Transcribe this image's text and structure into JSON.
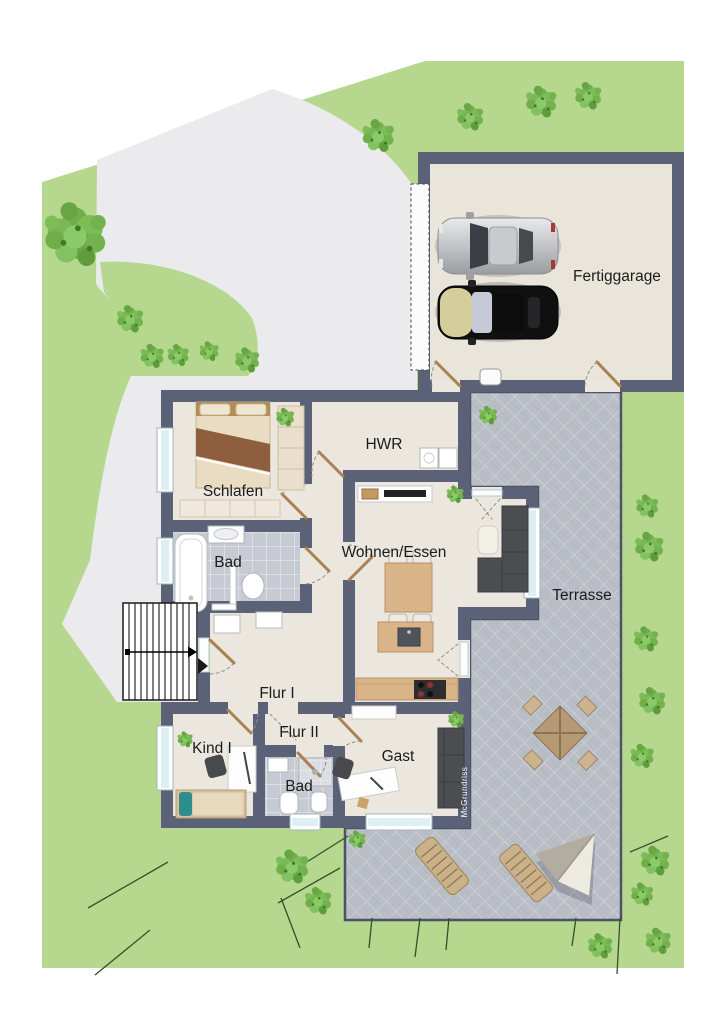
{
  "plan": {
    "type": "residential-site-floor-plan",
    "labels": {
      "garage": "Fertiggarage",
      "utility": "HWR",
      "bedroom": "Schlafen",
      "bath_upper": "Bad",
      "living_dining": "Wohnen/Essen",
      "terrace": "Terrasse",
      "hall_1": "Flur I",
      "hall_2": "Flur II",
      "child_room": "Kind I",
      "guest_room": "Gast",
      "bath_lower": "Bad",
      "watermark": "McGrundriss"
    },
    "colors": {
      "page_background": "#ffffff",
      "garden_green": "#b6d88e",
      "bush_green": "#6fae49",
      "driveway_gray": "#ebebee",
      "wall_dark": "#5b6277",
      "floor_cream": "#ece7de",
      "garage_floor": "#e9e5db",
      "bath_tile": "#c6cad2",
      "terrace_tile": "#b9bdc5",
      "window_blue": "#dceff2",
      "door_wood": "#a9824f",
      "furniture_wood": "#d8b488",
      "sofa_gray": "#4b4d50",
      "bed_blanket": "#8f5e3e",
      "car_silver": "#c9cacd",
      "car_black": "#101010",
      "car_hood_beige": "#d5cd9b"
    },
    "symbols": {
      "stairs": "exterior-stairs-with-direction-arrow",
      "cars": [
        "silver-car-top-view",
        "black-car-top-view"
      ],
      "garage_door": "dashed-sectional-door",
      "terrace_items": [
        "garden-table-with-4-chairs",
        "sun-lounger",
        "sun-lounger",
        "parasol"
      ],
      "rooms_fixtures": [
        "double-bed",
        "wardrobe",
        "bathtub",
        "sink",
        "toilet",
        "sideboard-tv",
        "dining-table-4-chairs",
        "kitchen-island",
        "kitchen-counter-stove",
        "corner-sofa",
        "desk-with-chair",
        "single-bed",
        "shower",
        "guest-sofa"
      ]
    }
  }
}
